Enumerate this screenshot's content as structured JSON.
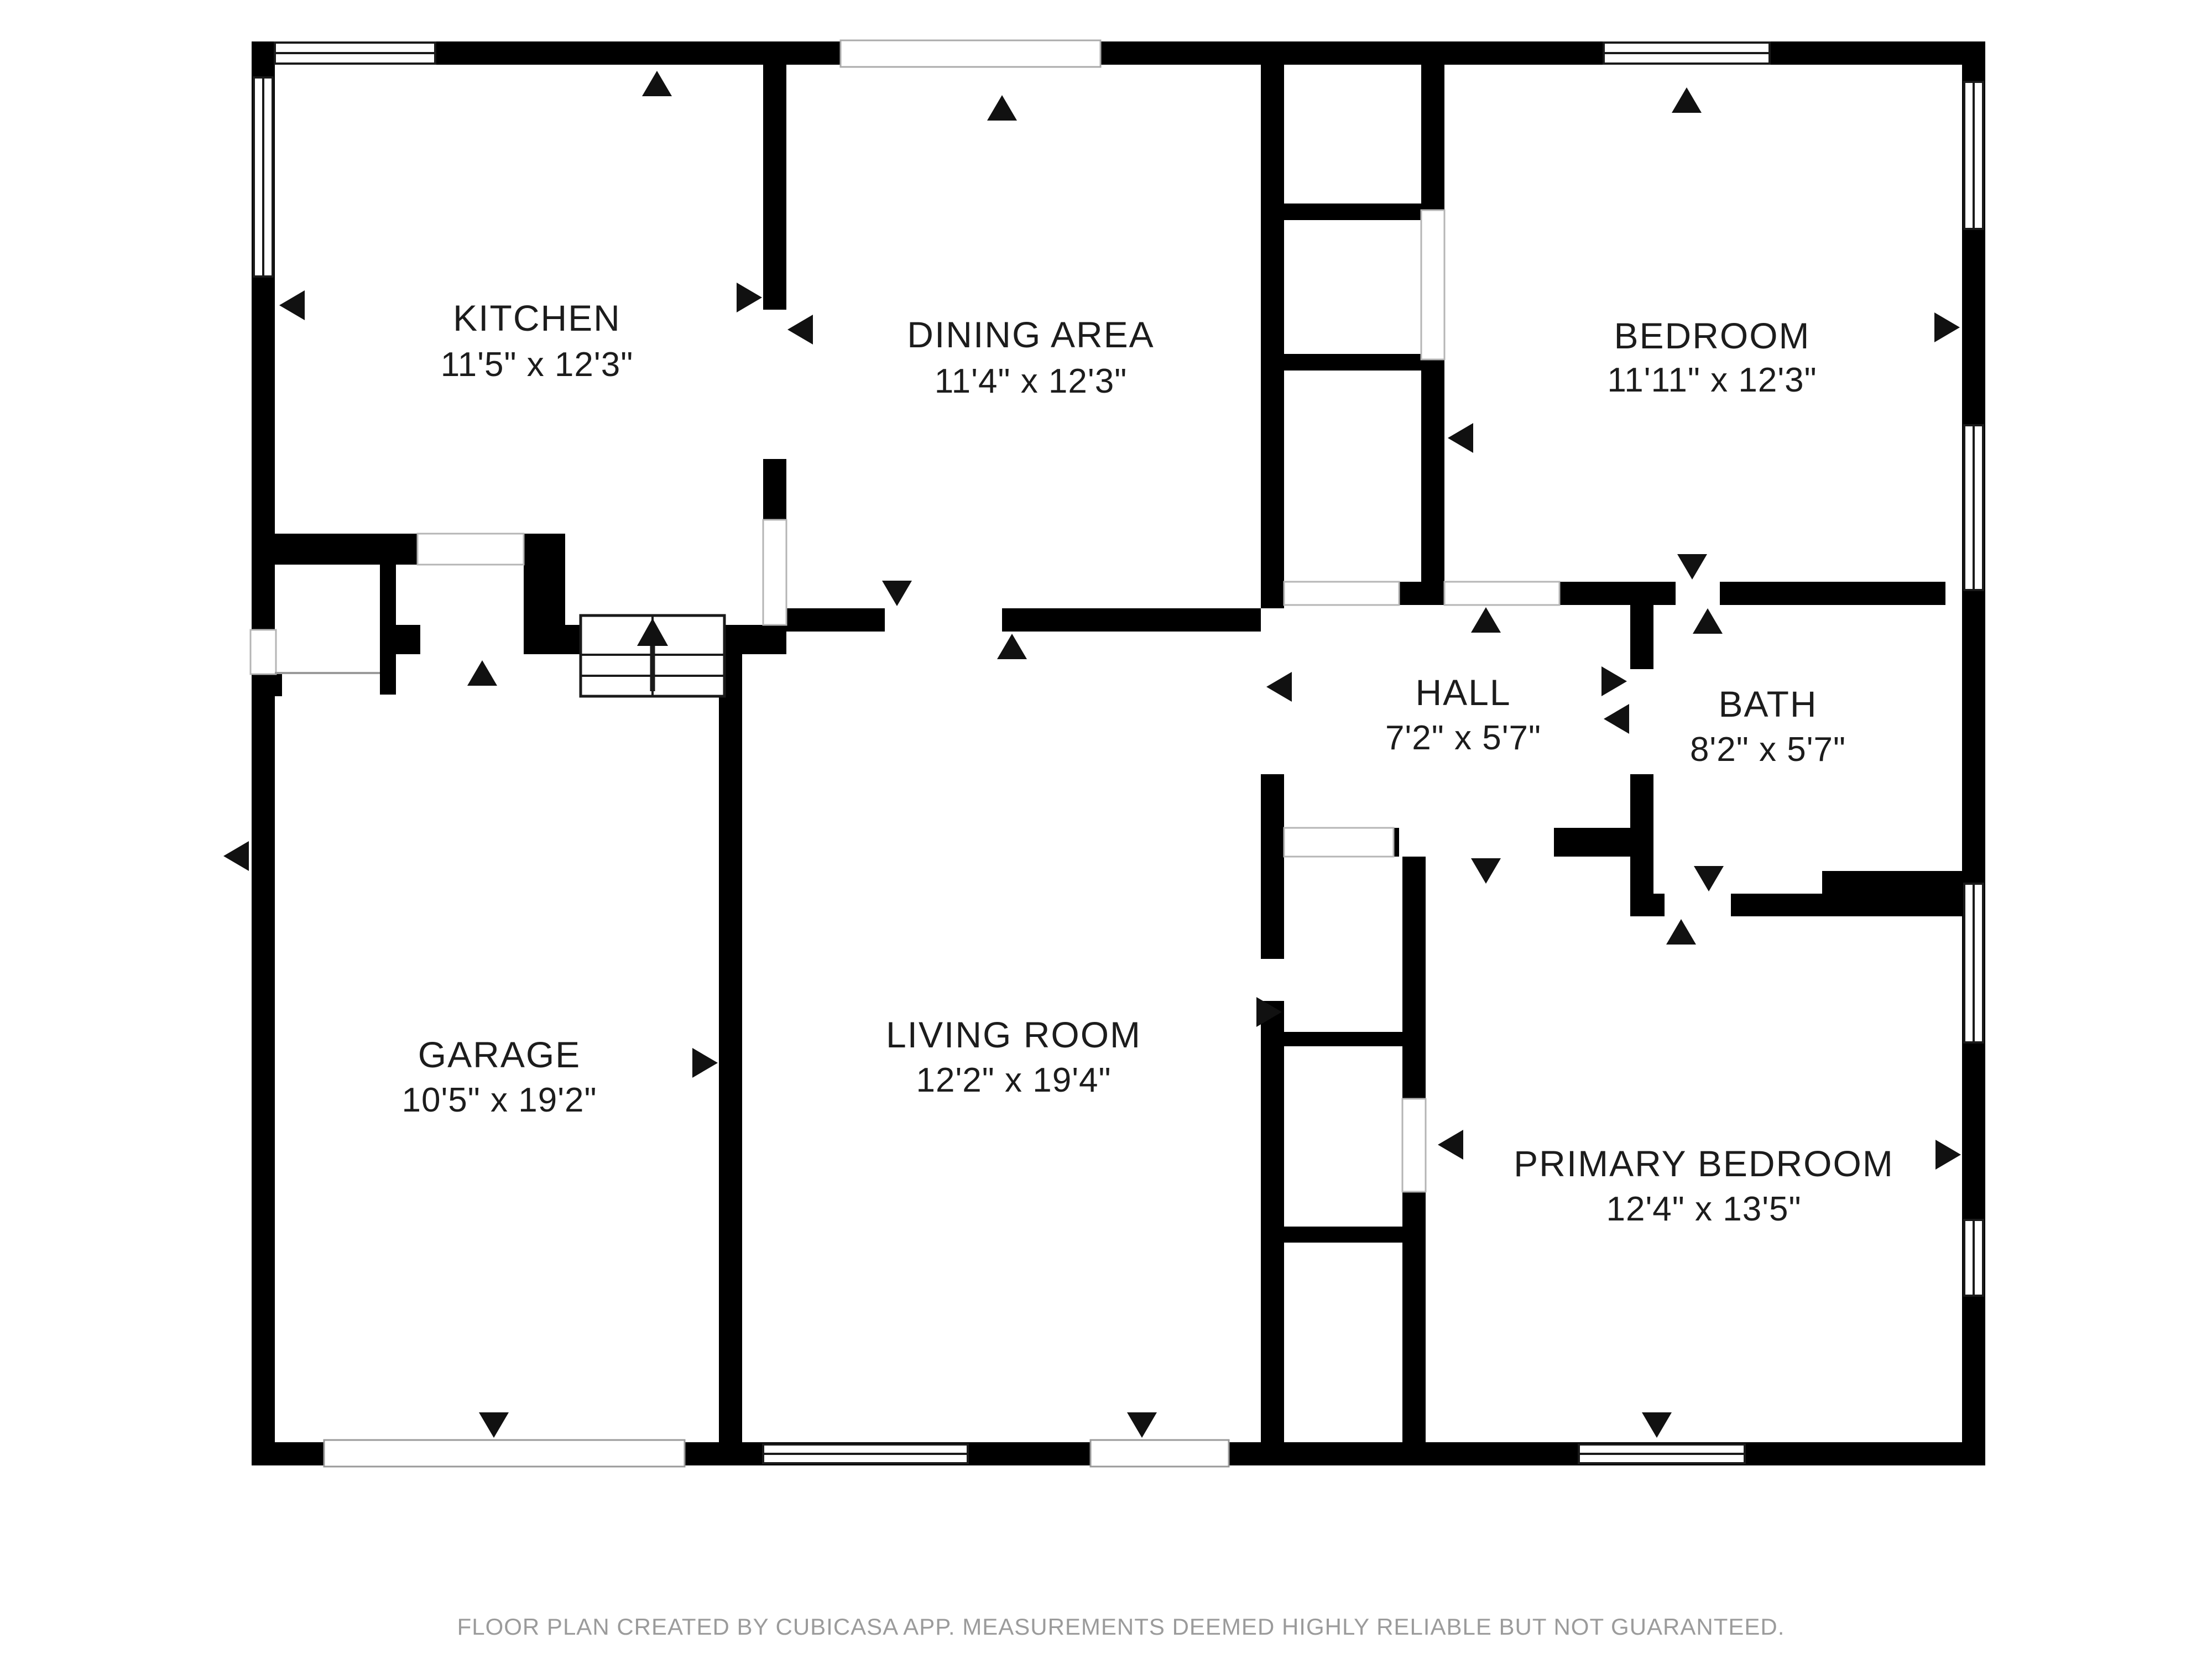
{
  "page": {
    "type": "residential-floor-plan",
    "background": "#ffffff"
  },
  "rooms": {
    "kitchen": {
      "name": "KITCHEN",
      "dimensions": "11'5\" x 12'3\""
    },
    "dining": {
      "name": "DINING AREA",
      "dimensions": "11'4\" x 12'3\""
    },
    "bedroom": {
      "name": "BEDROOM",
      "dimensions": "11'11\" x 12'3\""
    },
    "hall": {
      "name": "HALL",
      "dimensions": "7'2\" x 5'7\""
    },
    "bath": {
      "name": "BATH",
      "dimensions": "8'2\" x 5'7\""
    },
    "garage": {
      "name": "GARAGE",
      "dimensions": "10'5\" x 19'2\""
    },
    "living": {
      "name": "LIVING ROOM",
      "dimensions": "12'2\" x 19'4\""
    },
    "primary": {
      "name": "PRIMARY BEDROOM",
      "dimensions": "12'4\" x 13'5\""
    }
  },
  "footer": {
    "note": "FLOOR PLAN CREATED BY CUBICASA APP. MEASUREMENTS DEEMED HIGHLY RELIABLE BUT NOT GUARANTEED."
  },
  "colors": {
    "wall": "#000000",
    "background": "#ffffff",
    "label_text": "#1c1c1c",
    "footer_text": "#9b9b9b"
  }
}
